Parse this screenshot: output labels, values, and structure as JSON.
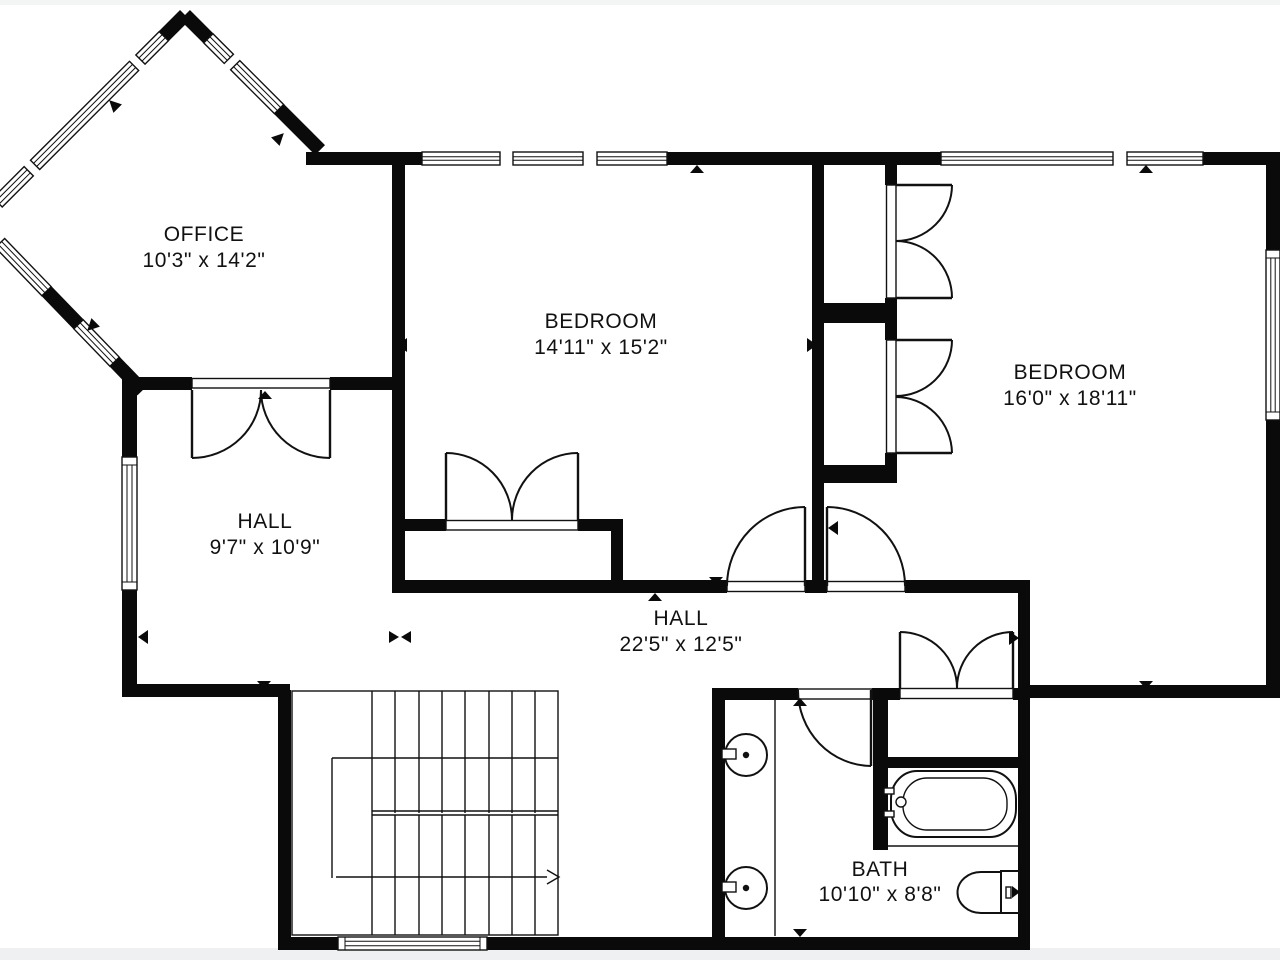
{
  "title": "Second floor plan",
  "colors": {
    "wall": "#0a0a0a",
    "background": "#ffffff",
    "page_edge": "#eef0f1",
    "line": "#111111"
  },
  "rooms": {
    "office": {
      "name": "OFFICE",
      "dims": "10'3\" x 14'2\""
    },
    "bedroom1": {
      "name": "BEDROOM",
      "dims": "14'11\" x 15'2\""
    },
    "bedroom2": {
      "name": "BEDROOM",
      "dims": "16'0\" x 18'11\""
    },
    "hall_upper": {
      "name": "HALL",
      "dims": "9'7\" x 10'9\""
    },
    "hall_main": {
      "name": "HALL",
      "dims": "22'5\" x 12'5\""
    },
    "bath": {
      "name": "BATH",
      "dims": "10'10\" x 8'8\""
    }
  },
  "fixtures": [
    "staircase",
    "bathtub",
    "toilet",
    "sink",
    "sink"
  ]
}
